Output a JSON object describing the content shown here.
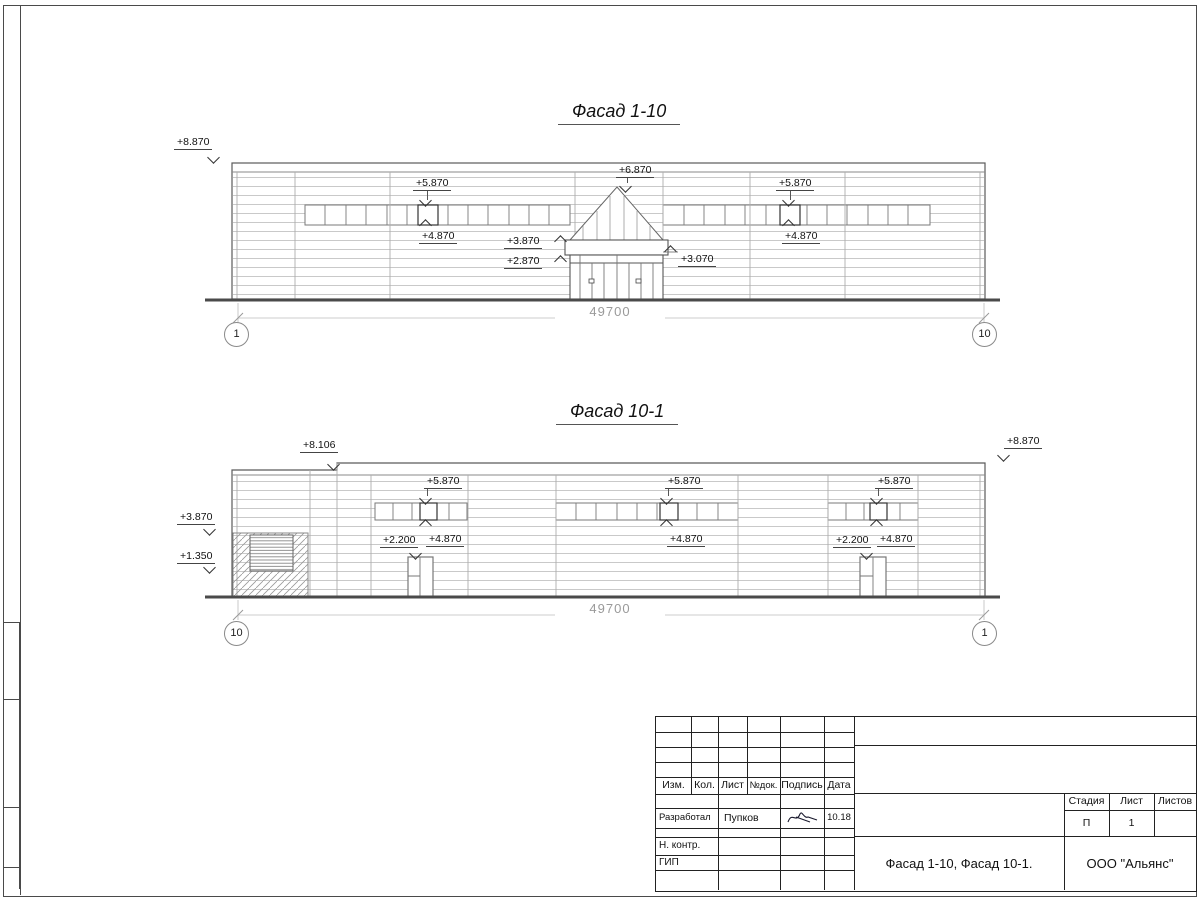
{
  "colors": {
    "line_dark": "#4a4a4a",
    "line_light": "#c9c9c9",
    "dim_text": "#9a9a9a"
  },
  "facade_top": {
    "title": "Фасад 1-10",
    "dimension": "49700",
    "axis_left": "1",
    "axis_right": "10",
    "marks": {
      "parapet_left": "+8.870",
      "band_left_top": "+5.870",
      "band_left_bottom": "+4.870",
      "ridge": "+6.870",
      "canopy_top": "+3.870",
      "canopy_bottom": "+2.870",
      "side_ledge": "+3.070",
      "band_right_top": "+5.870",
      "band_right_bottom": "+4.870"
    }
  },
  "facade_bottom": {
    "title": "Фасад 10-1",
    "dimension": "49700",
    "axis_left": "10",
    "axis_right": "1",
    "marks": {
      "parapet_step": "+8.106",
      "parapet_right": "+8.870",
      "ledge": "+3.870",
      "plinth": "+1.350",
      "band1_top": "+5.870",
      "band1_bottom": "+4.870",
      "door1": "+2.200",
      "band2_top": "+5.870",
      "band2_bottom": "+4.870",
      "band3_top": "+5.870",
      "band3_bottom": "+4.870",
      "door2": "+2.200"
    }
  },
  "title_block": {
    "col_headers": [
      "Изм.",
      "Кол.",
      "Лист",
      "№док.",
      "Подпись",
      "Дата"
    ],
    "developer_label": "Разработал",
    "developer_name": "Пупков",
    "developer_date": "10.18",
    "norm_control_label": "Н. контр.",
    "gip_label": "ГИП",
    "doc_title": "Фасад 1-10, Фасад 10-1.",
    "company": "ООО \"Альянс\"",
    "stage_label": "Стадия",
    "sheet_label": "Лист",
    "sheets_label": "Листов",
    "stage_value": "П",
    "sheet_value": "1",
    "sheets_value": ""
  }
}
